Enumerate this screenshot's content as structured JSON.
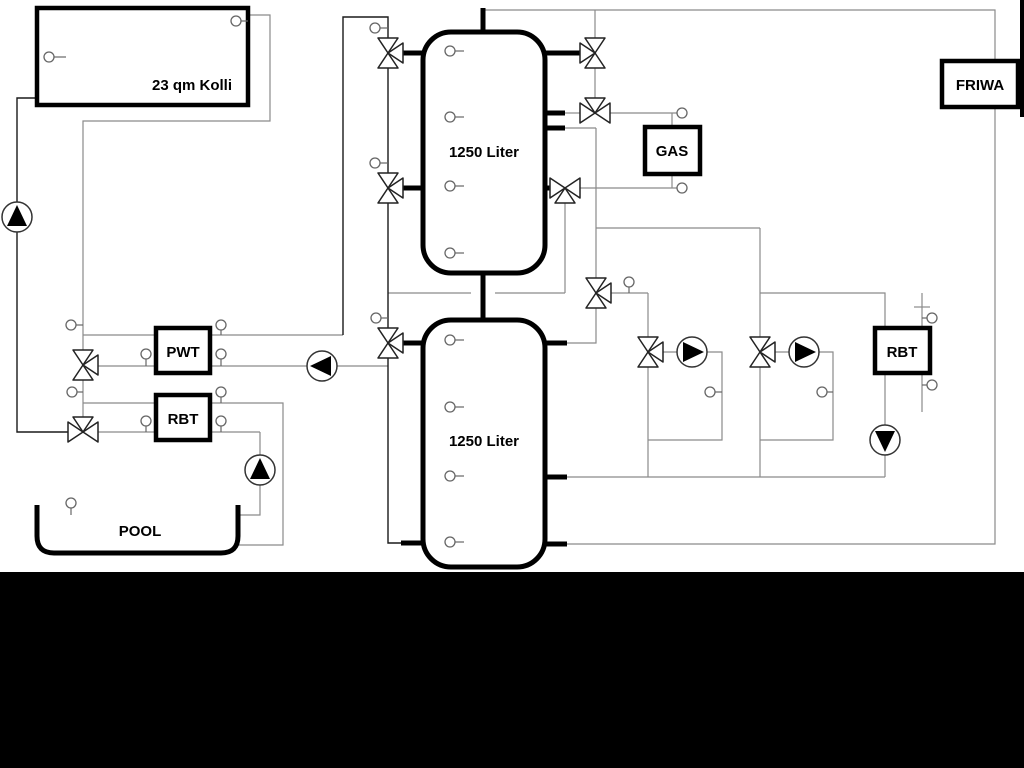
{
  "diagram": {
    "type": "hydraulic-schematic",
    "labels": {
      "collector": "23 qm Kolli",
      "tank_top": "1250 Liter",
      "tank_bottom": "1250 Liter",
      "gas": "GAS",
      "friwa": "FRIWA",
      "pwt": "PWT",
      "rbt_left": "RBT",
      "rbt_right": "RBT",
      "pool": "POOL"
    },
    "colors": {
      "background": "#ffffff",
      "pipe_gray": "#8a8a8a",
      "pipe_dark": "#1a1a1a",
      "component_black": "#000000",
      "footer_bar": "#000000"
    },
    "icons": [
      "pump-icon",
      "three-way-valve-icon",
      "temperature-sensor-icon"
    ],
    "component_counts": {
      "pumps": 6,
      "three_way_valves": 11,
      "temperature_sensors": 21
    }
  }
}
